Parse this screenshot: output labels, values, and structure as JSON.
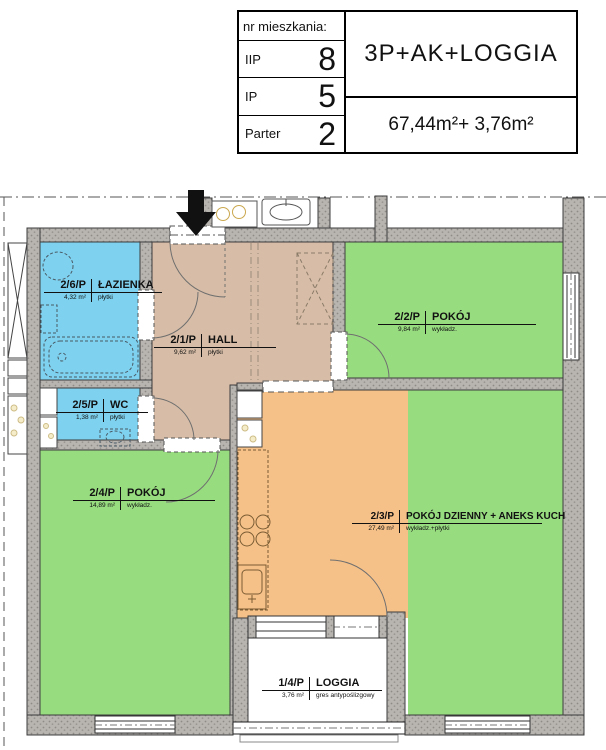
{
  "title_block": {
    "header": "nr mieszkania:",
    "floors": [
      {
        "label": "IIP",
        "number": "8"
      },
      {
        "label": "IP",
        "number": "5"
      },
      {
        "label": "Parter",
        "number": "2"
      }
    ],
    "unit_type": "3P+AK+LOGGIA",
    "areas": "67,44m²+ 3,76m²"
  },
  "rooms": {
    "lazienka": {
      "code": "2/6/P",
      "name": "ŁAZIENKA",
      "area": "4,32 m²",
      "finish": "płytki"
    },
    "hall": {
      "code": "2/1/P",
      "name": "HALL",
      "area": "9,62 m²",
      "finish": "płytki"
    },
    "pokoj2": {
      "code": "2/2/P",
      "name": "POKÓJ",
      "area": "9,84 m²",
      "finish": "wykładz."
    },
    "wc": {
      "code": "2/5/P",
      "name": "WC",
      "area": "1,38 m²",
      "finish": "płytki"
    },
    "pokoj4": {
      "code": "2/4/P",
      "name": "POKÓJ",
      "area": "14,89 m²",
      "finish": "wykładz."
    },
    "dzienny": {
      "code": "2/3/P",
      "name": "POKÓJ DZIENNY + ANEKS KUCH",
      "area": "27,49 m²",
      "finish": "wykładz.+płytki"
    },
    "loggia": {
      "code": "1/4/P",
      "name": "LOGGIA",
      "area": "3,76 m²",
      "finish": "gres antypoślizgowy"
    }
  },
  "colors": {
    "bathroom_blue": "#7fd2ef",
    "room_green": "#98dc80",
    "kitchen_orange": "#f6c189",
    "hall_tan": "#d7bda7",
    "loggia_white": "#ffffff",
    "wall_gray": "#b5b2ae",
    "arrow_black": "#111111"
  }
}
